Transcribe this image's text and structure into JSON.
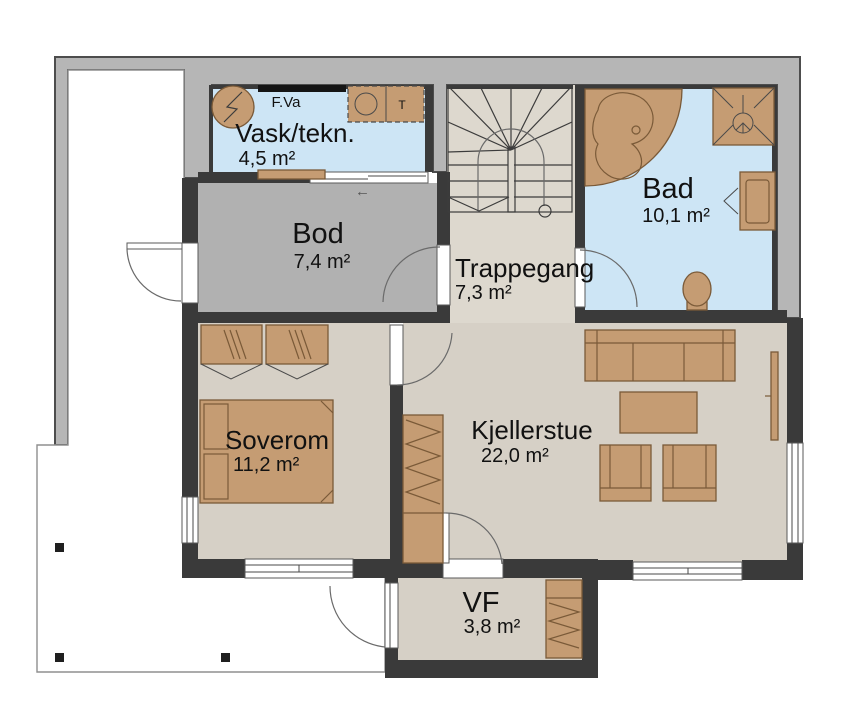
{
  "rooms": [
    {
      "name": "Vask/tekn.",
      "area": "4,5 m²"
    },
    {
      "name": "Bod",
      "area": "7,4 m²"
    },
    {
      "name": "Trappegang",
      "area": "7,3 m²"
    },
    {
      "name": "Bad",
      "area": "10,1 m²"
    },
    {
      "name": "Soverom",
      "area": "11,2 m²"
    },
    {
      "name": "Kjellerstue",
      "area": "22,0 m²"
    },
    {
      "name": "VF",
      "area": "3,8 m²"
    }
  ],
  "annotations": {
    "water_manifold": "F.Va",
    "dryer": "T",
    "sliding_door_arrow": "←"
  },
  "colors": {
    "terrain": "#b6b6b6",
    "wall": "#3a3a3a",
    "wet_floor": "#cde5f5",
    "dry_floor": "#d6d0c6",
    "stairs_floor": "#ddd8ce",
    "bod_floor": "#b1b1b1",
    "furniture": "#c59c73",
    "furniture_outline": "#7a5a38",
    "text": "#111111"
  }
}
